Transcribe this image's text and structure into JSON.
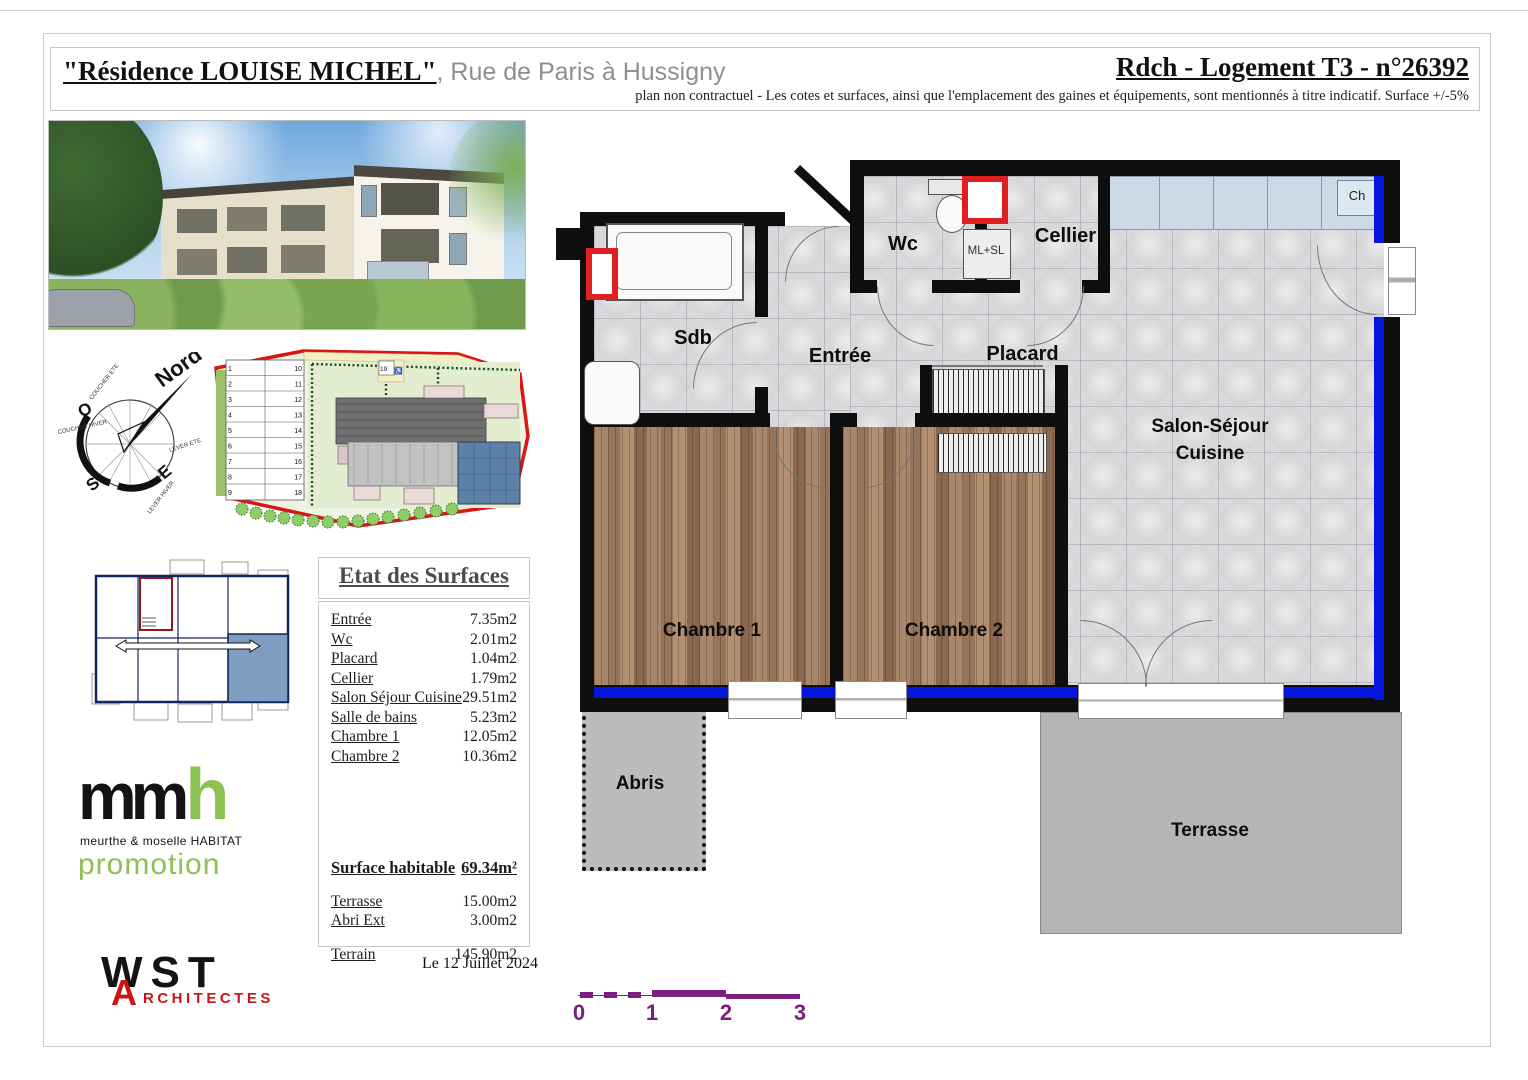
{
  "header": {
    "title_quote": "\"Résidence LOUISE MICHEL\"",
    "title_rest": ", Rue de Paris à Hussigny",
    "unit_title": "Rdch - Logement T3 - n°26392",
    "disclaimer": "plan non contractuel - Les cotes et surfaces, ainsi que l'emplacement des gaines et équipements, sont mentionnés à titre indicatif. Surface +/-5%"
  },
  "surfaces": {
    "title": "Etat des Surfaces",
    "rows": [
      {
        "label": "Entrée",
        "value": "7.35m2"
      },
      {
        "label": "Wc",
        "value": "2.01m2"
      },
      {
        "label": "Placard",
        "value": "1.04m2"
      },
      {
        "label": "Cellier",
        "value": "1.79m2"
      },
      {
        "label": "Salon Séjour Cuisine",
        "value": "29.51m2"
      },
      {
        "label": "Salle de bains",
        "value": "5.23m2"
      },
      {
        "label": "Chambre 1",
        "value": "12.05m2"
      },
      {
        "label": "Chambre 2",
        "value": "10.36m2"
      }
    ],
    "habitable_label": "Surface habitable",
    "habitable_value": "69.34m²",
    "terrasse_label": "Terrasse",
    "terrasse_value": "15.00m2",
    "abri_label": "Abri Ext",
    "abri_value": "3.00m2",
    "terrain_label": "Terrain",
    "terrain_value": "145.90m2"
  },
  "plan": {
    "sdb": "Sdb",
    "wc": "Wc",
    "cellier": "Cellier",
    "ml_sl": "ML+SL",
    "ch": "Ch",
    "entree": "Entrée",
    "placard": "Placard",
    "salon_line1": "Salon-Séjour",
    "salon_line2": "Cuisine",
    "chambre1": "Chambre 1",
    "chambre2": "Chambre 2",
    "abris": "Abris",
    "terrasse": "Terrasse"
  },
  "compass": {
    "nord": "Nord",
    "o": "O",
    "s": "S",
    "e": "E",
    "coucher_ete": "COUCHER ETE",
    "coucher_hiver": "COUCHER HIVER",
    "lever_ete": "LEVER ETE",
    "lever_hiver": "LEVER HIVER"
  },
  "site_plan": {
    "stalls_left": [
      "1",
      "2",
      "3",
      "4",
      "5",
      "6",
      "7",
      "8",
      "9"
    ],
    "stalls_right": [
      "10",
      "11",
      "12",
      "13",
      "14",
      "15",
      "16",
      "17",
      "18"
    ],
    "accessible_stall": "19"
  },
  "logos": {
    "mmh_mm": "mm",
    "mmh_h": "h",
    "mmh_sub": "meurthe & moselle HABITAT",
    "mmh_promotion": "promotion",
    "wst": "WST",
    "wst_a": "A",
    "wst_rest": "RCHITECTES"
  },
  "footer": {
    "date": "Le 12 Juillet 2024",
    "scale": [
      "0",
      "1",
      "2",
      "3"
    ]
  },
  "colors": {
    "window_blue": "#0517dd",
    "gaine_red": "#e02020",
    "scale_purple": "#7a1f7d",
    "mmh_green": "#8dc153",
    "wst_red": "#cc1414"
  }
}
